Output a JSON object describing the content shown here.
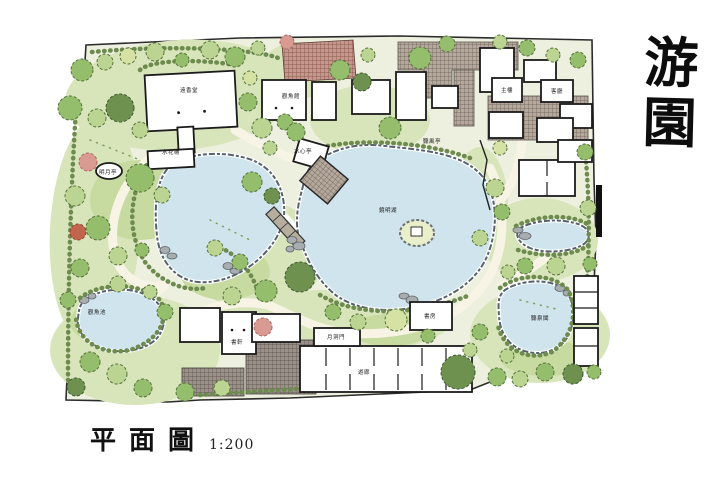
{
  "title": {
    "calligraphy": "游園"
  },
  "caption": {
    "text": "平面圖",
    "scale": "1:200"
  },
  "palette": {
    "paper": "#ffffff",
    "ground": "#eef0df",
    "planting": "#d8e5ba",
    "lawn": "#c7dba1",
    "water": "#cfe4ed",
    "water_edge": "#55616c",
    "path": "#f7f4e5",
    "building": "#ffffff",
    "ink": "#1b1b1b",
    "wall": "#2b2b2b",
    "tree_light": "#bcd492",
    "tree_mid": "#94bd6c",
    "tree_dark": "#6f9150",
    "tree_yellow": "#d6e2a4",
    "tree_edge": "#55713d",
    "flower_red": "#c2654e",
    "flower_pink": "#d99a92",
    "shrub": "#6d8a4f",
    "rock": "#a8adb0",
    "rock_edge": "#5f666b",
    "paving_red_bg": "#c4988d",
    "paving_red_line": "#7e4a40",
    "paving_gray_bg": "#b5a89c",
    "paving_gray_line": "#675c52",
    "paving_dark_bg": "#9b9188",
    "paving_dark_line": "#554e47"
  },
  "plan": {
    "scale_note": "1:200",
    "labels": [
      {
        "text": "遠香堂",
        "x": 189,
        "y": 92
      },
      {
        "text": "水花榭",
        "x": 171,
        "y": 154
      },
      {
        "text": "明月亭",
        "x": 108,
        "y": 174
      },
      {
        "text": "觀魚館",
        "x": 291,
        "y": 98
      },
      {
        "text": "水心亭",
        "x": 303,
        "y": 153
      },
      {
        "text": "聽風亭",
        "x": 432,
        "y": 143
      },
      {
        "text": "鏡明湖",
        "x": 388,
        "y": 212
      },
      {
        "text": "觀魚池",
        "x": 97,
        "y": 314
      },
      {
        "text": "書軒",
        "x": 237,
        "y": 344
      },
      {
        "text": "月洞門",
        "x": 336,
        "y": 339
      },
      {
        "text": "遊廊",
        "x": 364,
        "y": 374
      },
      {
        "text": "書房",
        "x": 430,
        "y": 318
      },
      {
        "text": "聽泉閣",
        "x": 540,
        "y": 320
      },
      {
        "text": "主樓",
        "x": 507,
        "y": 92
      },
      {
        "text": "客廳",
        "x": 557,
        "y": 93
      }
    ]
  }
}
